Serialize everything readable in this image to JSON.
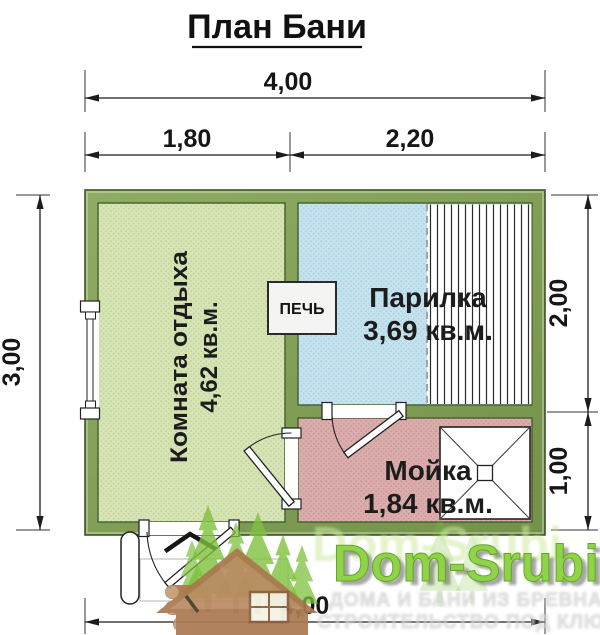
{
  "title": "План Бани",
  "dimensions": {
    "overall_width_top": "4,00",
    "rest_room_width": "1,80",
    "right_section_width": "2,20",
    "overall_depth_left": "3,00",
    "steam_room_depth": "2,00",
    "wash_room_depth": "1,00",
    "overall_width_bottom": "4,00"
  },
  "rooms": {
    "rest": {
      "name": "Комната отдыха",
      "area": "4,62 кв.м."
    },
    "steam": {
      "name": "Парилка",
      "area": "3,69 кв.м."
    },
    "wash": {
      "name": "Мойка",
      "area": "1,84 кв.м."
    },
    "stove_label": "ПЕЧЬ"
  },
  "watermark": {
    "brand": "Dom-Srubi",
    "tagline_line1": "ДОМА И БАНИ ИЗ БРЕВНА",
    "tagline_line2": "СТРОИТЕЛЬСТВО ПОД КЛЮЧ"
  },
  "colors": {
    "wall_green": "#7d9b51",
    "wall_outline": "#3d5723",
    "rest_room_fill": "#d7e4b6",
    "steam_room_fill": "#c5e2ee",
    "wash_room_fill": "#dcadad",
    "stove_fill": "#f4f4f3",
    "dimension_ink": "#161616",
    "watermark_green": "#8ed348",
    "watermark_brown": "#aa7850"
  }
}
